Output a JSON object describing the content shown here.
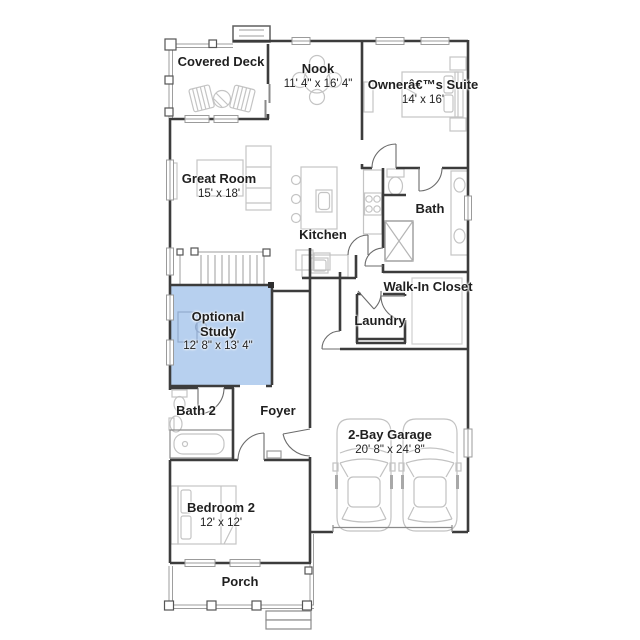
{
  "plan": {
    "type": "floor-plan",
    "rooms": [
      {
        "name": "Covered Deck",
        "dims": ""
      },
      {
        "name": "Nook",
        "dims": "11' 4\" x 16' 4\""
      },
      {
        "name": "Ownerâ€™s Suite",
        "dims": "14' x 16'"
      },
      {
        "name": "Great Room",
        "dims": "15' x 18'"
      },
      {
        "name": "Kitchen",
        "dims": ""
      },
      {
        "name": "Bath",
        "dims": ""
      },
      {
        "name": "Walk-In Closet",
        "dims": ""
      },
      {
        "name": "Optional Study",
        "dims": "12' 8\" x 13' 4\"",
        "highlighted": true
      },
      {
        "name": "Laundry",
        "dims": ""
      },
      {
        "name": "Bath 2",
        "dims": ""
      },
      {
        "name": "Foyer",
        "dims": ""
      },
      {
        "name": "2-Bay Garage",
        "dims": "20' 8\" x 24' 8\""
      },
      {
        "name": "Bedroom 2",
        "dims": "12' x 12'"
      },
      {
        "name": "Porch",
        "dims": ""
      }
    ],
    "colors": {
      "highlight_fill": "#b7d0ef",
      "wall": "#3c3c3c",
      "furniture": "#c4c4c4",
      "door": "#6b6b6b",
      "rail": "#9e9e9e",
      "text": "#1f1f1f",
      "background": "#ffffff"
    }
  }
}
